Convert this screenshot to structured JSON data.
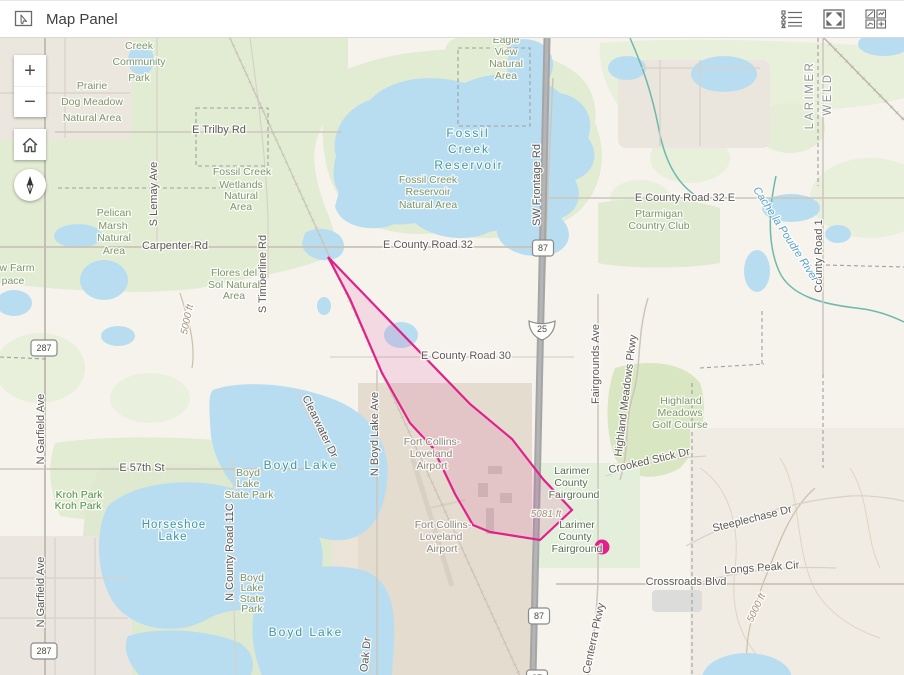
{
  "header": {
    "title": "Map Panel",
    "icons": [
      "map-panel-icon",
      "legend-list-icon",
      "expand-icon",
      "widget-grid-icon"
    ]
  },
  "controls": {
    "zoom_in": "+",
    "zoom_out": "−"
  },
  "colors": {
    "accent_overlay": "#e0218a",
    "header_icon": "#6a6a6a",
    "map_base": "#f6f3ed"
  },
  "map": {
    "label_colors": {
      "road": "#5d5954",
      "park": "#7d9468",
      "park_bright": "#4f8c3e",
      "park_dark": "#5a6d52",
      "water": "#3e96a4",
      "river": "#5aa2c8",
      "airport": "#8e8679",
      "county": "#909090",
      "contour": "#a3927a"
    },
    "labels": [
      {
        "t": "E Trilby Rd",
        "x": 219,
        "y": 95,
        "c": "road"
      },
      {
        "t": "Carpenter Rd",
        "x": 175,
        "y": 211,
        "c": "road"
      },
      {
        "t": "E County Road 32",
        "x": 428,
        "y": 210,
        "c": "road"
      },
      {
        "t": "E County Road 30",
        "x": 466,
        "y": 321,
        "c": "road"
      },
      {
        "t": "E County Road 32 E",
        "x": 685,
        "y": 163,
        "c": "road"
      },
      {
        "t": "E 57th St",
        "x": 142,
        "y": 433,
        "c": "road"
      },
      {
        "t": "Crossroads Blvd",
        "x": 686,
        "y": 547,
        "c": "road"
      },
      {
        "t": "Longs Peak Cir",
        "x": 762,
        "y": 533,
        "c": "road",
        "r": -4
      },
      {
        "t": "Steeplechase Dr",
        "x": 753,
        "y": 484,
        "c": "road",
        "r": -14
      },
      {
        "t": "Crooked Stick Dr",
        "x": 650,
        "y": 426,
        "c": "road",
        "r": -13
      },
      {
        "t": "S Lemay Ave",
        "x": 157,
        "y": 156,
        "c": "road",
        "r": -90
      },
      {
        "t": "S Timberline Rd",
        "x": 266,
        "y": 236,
        "c": "road",
        "r": -90
      },
      {
        "t": "SW Frontage Rd",
        "x": 540,
        "y": 147,
        "c": "road",
        "r": -90
      },
      {
        "t": "N Boyd Lake Ave",
        "x": 378,
        "y": 396,
        "c": "road",
        "r": -90
      },
      {
        "t": "N County Road 11C",
        "x": 233,
        "y": 514,
        "c": "road",
        "r": -90
      },
      {
        "t": "N Garfield Ave",
        "x": 44,
        "y": 391,
        "c": "road",
        "r": -90
      },
      {
        "t": "N Garfield Ave",
        "x": 44,
        "y": 554,
        "c": "road",
        "r": -90
      },
      {
        "t": "Fairgrounds Ave",
        "x": 599,
        "y": 326,
        "c": "road",
        "r": -90
      },
      {
        "t": "Highland Meadows Pkwy",
        "x": 629,
        "y": 358,
        "c": "road",
        "r": -83
      },
      {
        "t": "County Road 1",
        "x": 822,
        "y": 218,
        "c": "road",
        "r": -90
      },
      {
        "t": "Centerra Pkwy",
        "x": 597,
        "y": 601,
        "c": "road",
        "r": -78
      },
      {
        "t": "Clearwater Dr",
        "x": 317,
        "y": 390,
        "c": "road",
        "r": 64
      },
      {
        "t": "Oak Dr",
        "x": 369,
        "y": 617,
        "c": "road",
        "r": -84
      },
      {
        "t": "Creek",
        "x": 139,
        "y": 11,
        "c": "park"
      },
      {
        "t": "Community",
        "x": 139,
        "y": 27,
        "c": "park"
      },
      {
        "t": "Park",
        "x": 139,
        "y": 43,
        "c": "park"
      },
      {
        "t": "Prairie",
        "x": 92,
        "y": 51,
        "c": "park"
      },
      {
        "t": "Dog Meadow",
        "x": 92,
        "y": 67,
        "c": "park"
      },
      {
        "t": "Natural Area",
        "x": 92,
        "y": 83,
        "c": "park"
      },
      {
        "t": "Pelican",
        "x": 114,
        "y": 178,
        "c": "park"
      },
      {
        "t": "Marsh",
        "x": 113,
        "y": 191,
        "c": "park"
      },
      {
        "t": "Natural",
        "x": 114,
        "y": 203,
        "c": "park"
      },
      {
        "t": "Area",
        "x": 114,
        "y": 216,
        "c": "park"
      },
      {
        "t": "Fossil Creek",
        "x": 242,
        "y": 137,
        "c": "park"
      },
      {
        "t": "Wetlands",
        "x": 241,
        "y": 150,
        "c": "park"
      },
      {
        "t": "Natural",
        "x": 241,
        "y": 161,
        "c": "park"
      },
      {
        "t": "Area",
        "x": 241,
        "y": 172,
        "c": "park"
      },
      {
        "t": "Fossil Creek",
        "x": 428,
        "y": 145,
        "c": "park"
      },
      {
        "t": "Reservoir",
        "x": 428,
        "y": 157,
        "c": "park"
      },
      {
        "t": "Natural Area",
        "x": 428,
        "y": 170,
        "c": "park"
      },
      {
        "t": "Flores del",
        "x": 234,
        "y": 238,
        "c": "park"
      },
      {
        "t": "Sol Natural",
        "x": 234,
        "y": 250,
        "c": "park"
      },
      {
        "t": "Area",
        "x": 234,
        "y": 261,
        "c": "park"
      },
      {
        "t": "Eagle",
        "x": 506,
        "y": 5,
        "c": "park"
      },
      {
        "t": "View",
        "x": 506,
        "y": 17,
        "c": "park"
      },
      {
        "t": "Natural",
        "x": 506,
        "y": 29,
        "c": "park"
      },
      {
        "t": "Area",
        "x": 506,
        "y": 41,
        "c": "park"
      },
      {
        "t": "Ptarmigan",
        "x": 659,
        "y": 179,
        "c": "park"
      },
      {
        "t": "Country Club",
        "x": 659,
        "y": 191,
        "c": "park"
      },
      {
        "t": "Highland",
        "x": 681,
        "y": 366,
        "c": "park"
      },
      {
        "t": "Meadows",
        "x": 680,
        "y": 378,
        "c": "park"
      },
      {
        "t": "Golf Course",
        "x": 680,
        "y": 390,
        "c": "park"
      },
      {
        "t": "Boyd",
        "x": 248,
        "y": 438,
        "c": "park"
      },
      {
        "t": "Lake",
        "x": 248,
        "y": 449,
        "c": "park"
      },
      {
        "t": "State Park",
        "x": 249,
        "y": 460,
        "c": "park"
      },
      {
        "t": "Boyd",
        "x": 252,
        "y": 543,
        "c": "park"
      },
      {
        "t": "Lake",
        "x": 252,
        "y": 553,
        "c": "park"
      },
      {
        "t": "State",
        "x": 252,
        "y": 564,
        "c": "park"
      },
      {
        "t": "Park",
        "x": 252,
        "y": 574,
        "c": "park"
      },
      {
        "t": "w Farm",
        "x": 17,
        "y": 233,
        "c": "park"
      },
      {
        "t": "pace",
        "x": 13,
        "y": 246,
        "c": "park"
      },
      {
        "t": "Kroh Park",
        "x": 79,
        "y": 460,
        "c": "park_bright"
      },
      {
        "t": "Kroh Park",
        "x": 78,
        "y": 471,
        "c": "park_bright"
      },
      {
        "t": "Larimer",
        "x": 572,
        "y": 436,
        "c": "park_dark"
      },
      {
        "t": "County",
        "x": 571,
        "y": 448,
        "c": "park_dark"
      },
      {
        "t": "Fairground",
        "x": 574,
        "y": 460,
        "c": "park_dark"
      },
      {
        "t": "Larimer",
        "x": 577,
        "y": 490,
        "c": "park_dark"
      },
      {
        "t": "County",
        "x": 575,
        "y": 502,
        "c": "park_dark"
      },
      {
        "t": "Fairground",
        "x": 577,
        "y": 514,
        "c": "park_dark"
      },
      {
        "t": "Fort Collins-",
        "x": 432,
        "y": 407,
        "c": "airport"
      },
      {
        "t": "Loveland",
        "x": 431,
        "y": 419,
        "c": "airport"
      },
      {
        "t": "Airport",
        "x": 432,
        "y": 431,
        "c": "airport"
      },
      {
        "t": "Fort Collins-",
        "x": 443,
        "y": 490,
        "c": "airport"
      },
      {
        "t": "Loveland",
        "x": 441,
        "y": 502,
        "c": "airport"
      },
      {
        "t": "Airport",
        "x": 442,
        "y": 514,
        "c": "airport"
      },
      {
        "t": "Fossil",
        "x": 468,
        "y": 99,
        "c": "water"
      },
      {
        "t": "Creek",
        "x": 469,
        "y": 115,
        "c": "water"
      },
      {
        "t": "Reservoir",
        "x": 469,
        "y": 131,
        "c": "water"
      },
      {
        "t": "Boyd Lake",
        "x": 301,
        "y": 431,
        "c": "water"
      },
      {
        "t": "Boyd Lake",
        "x": 306,
        "y": 598,
        "c": "water"
      },
      {
        "t": "Horseshoe",
        "x": 174,
        "y": 490,
        "c": "water",
        "s": 11.5,
        "ls": 1
      },
      {
        "t": "Lake",
        "x": 173,
        "y": 502,
        "c": "water",
        "s": 11.5,
        "ls": 1
      },
      {
        "t": "Cache la Poudre River",
        "x": 783,
        "y": 198,
        "c": "river",
        "r": 57,
        "i": true,
        "s": 11
      },
      {
        "t": "LARIMER",
        "x": 813,
        "y": 57,
        "c": "county",
        "r": -90
      },
      {
        "t": "WELD",
        "x": 831,
        "y": 56,
        "c": "county",
        "r": -90
      },
      {
        "t": "5081 ft",
        "x": 546,
        "y": 479,
        "c": "contour",
        "i": true
      },
      {
        "t": "5000 ft",
        "x": 190,
        "y": 282,
        "c": "contour",
        "i": true,
        "r": -78
      },
      {
        "t": "5000 ft",
        "x": 759,
        "y": 571,
        "c": "contour",
        "i": true,
        "r": -65
      }
    ],
    "shields": [
      {
        "k": "us",
        "n": "287",
        "x": 44,
        "y": 310
      },
      {
        "k": "us",
        "n": "287",
        "x": 44,
        "y": 613
      },
      {
        "k": "us",
        "n": "87",
        "x": 543,
        "y": 210
      },
      {
        "k": "us",
        "n": "87",
        "x": 539,
        "y": 578
      },
      {
        "k": "us",
        "n": "87",
        "x": 537,
        "y": 640
      },
      {
        "k": "i",
        "n": "25",
        "x": 542,
        "y": 291
      }
    ],
    "overlay": {
      "stroke": "#e0218a",
      "fill": "#e0218a",
      "fill_opacity": 0.12,
      "polygon": [
        [
          328,
          219
        ],
        [
          470,
          366
        ],
        [
          512,
          401
        ],
        [
          543,
          441
        ],
        [
          572,
          472
        ],
        [
          540,
          502
        ],
        [
          490,
          494
        ],
        [
          473,
          487
        ],
        [
          455,
          456
        ],
        [
          433,
          410
        ],
        [
          410,
          385
        ],
        [
          382,
          335
        ],
        [
          350,
          261
        ]
      ],
      "point": {
        "x": 602,
        "y": 509,
        "r": 7.5
      }
    }
  }
}
